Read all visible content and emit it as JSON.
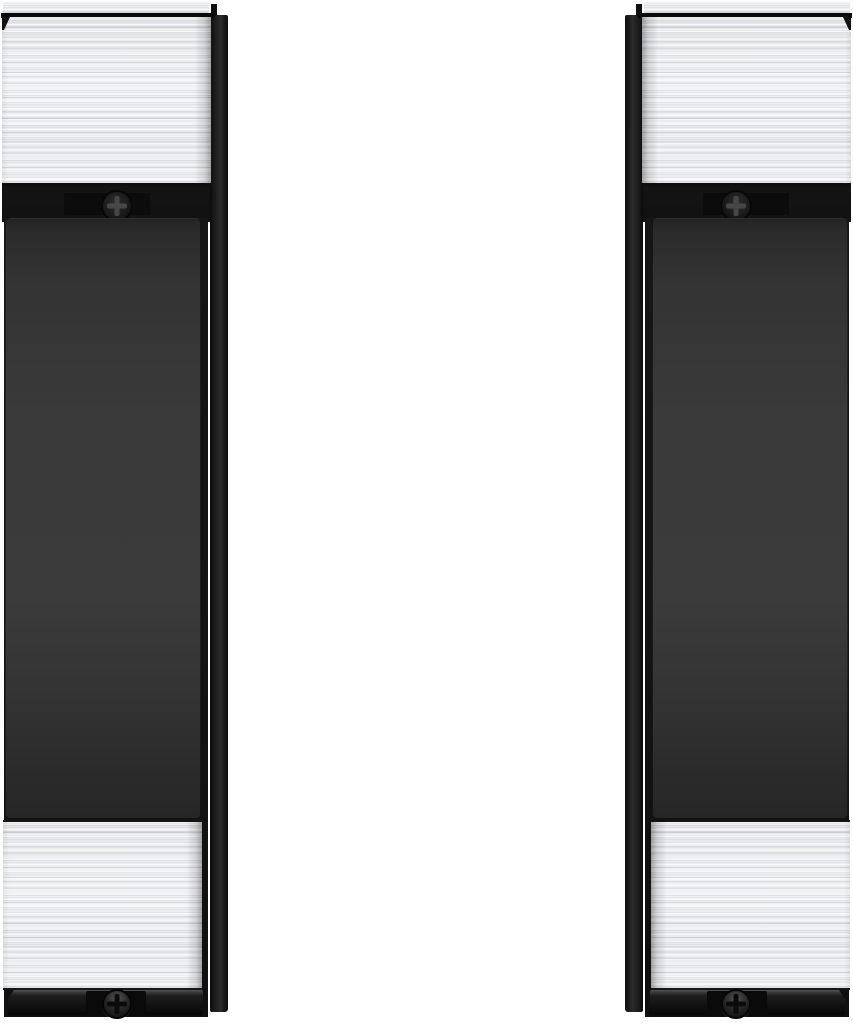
{
  "scene": {
    "type": "product-photo",
    "background_color": "#ffffff",
    "items_count": 2,
    "description": "Mirrored pair of vertical mounting brackets (left-hand and right-hand). Each has a brushed stainless-steel cap at top and bottom, a matte dark-gray front panel, a black side mounting rail, a thin steel trim strip at the very top, a black base bracket at the very bottom, and Phillips screws visible below the top cap and in the bottom base."
  },
  "palette": {
    "background": "#ffffff",
    "steel_light": "#f1f2f4",
    "steel_base": "#e9eaed",
    "steel_streak_dark": "#d8d9dc",
    "panel_gray": "#3a3a3a",
    "panel_gray_dark": "#262626",
    "body_black": "#141414",
    "rail_black": "#242424",
    "seam_black": "#0a0a0a",
    "screw_slot_light": "#474747",
    "screw_slot_dark": "#0b0b0b"
  },
  "items": [
    {
      "id": "bracket-left",
      "side": "left",
      "orientation": "rail-on-right",
      "parts": {
        "top_trim": "brushed steel trim strip",
        "top_cap": "brushed steel cap",
        "top_screw": "phillips screw on black plate",
        "front_panel": "matte black center panel",
        "bottom_cap": "brushed steel cap",
        "base_bracket": "black mounting base with phillips screw",
        "side_rail": "black vertical mounting rail"
      }
    },
    {
      "id": "bracket-right",
      "side": "right",
      "orientation": "rail-on-left",
      "parts": {
        "top_trim": "brushed steel trim strip",
        "top_cap": "brushed steel cap",
        "top_screw": "phillips screw on black plate",
        "front_panel": "matte black center panel",
        "bottom_cap": "brushed steel cap",
        "base_bracket": "black mounting base with phillips screw",
        "side_rail": "black vertical mounting rail"
      }
    }
  ]
}
